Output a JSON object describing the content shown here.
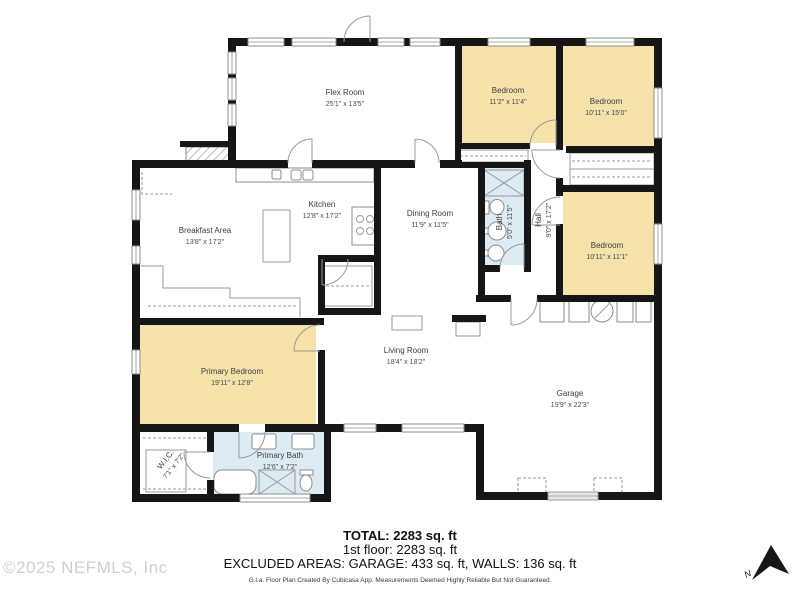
{
  "watermark": "©2025 NEFMLS, Inc",
  "compass_label": "N",
  "rooms": {
    "flex": {
      "name": "Flex Room",
      "dims": "25'1\" x 13'5\""
    },
    "bedroom1": {
      "name": "Bedroom",
      "dims": "11'2\" x 11'4\""
    },
    "bedroom2": {
      "name": "Bedroom",
      "dims": "10'11\" x 15'0\""
    },
    "kitchen": {
      "name": "Kitchen",
      "dims": "12'8\" x 17'2\""
    },
    "dining": {
      "name": "Dining Room",
      "dims": "11'9\" x 11'5\""
    },
    "bath": {
      "name": "Bath",
      "dims": "5'0\" x 11'5\""
    },
    "hall": {
      "name": "Hall",
      "dims": "9'0\" x 17'2\""
    },
    "bedroom3": {
      "name": "Bedroom",
      "dims": "10'11\" x 11'1\""
    },
    "breakfast": {
      "name": "Breakfast Area",
      "dims": "13'8\" x 17'2\""
    },
    "primary_bedroom": {
      "name": "Primary Bedroom",
      "dims": "19'11\" x 12'8\""
    },
    "living": {
      "name": "Living Room",
      "dims": "18'4\" x 18'2\""
    },
    "garage": {
      "name": "Garage",
      "dims": "19'9\" x 22'3\""
    },
    "wic": {
      "name": "W.I.C.",
      "dims": "7'1\" x 7'2\""
    },
    "primary_bath": {
      "name": "Primary Bath",
      "dims": "12'6\" x 7'2\""
    }
  },
  "summary": {
    "total": "TOTAL: 2283 sq. ft",
    "floor": "1st floor: 2283 sq. ft",
    "excluded": "EXCLUDED AREAS: GARAGE: 433 sq. ft, WALLS: 136 sq. ft",
    "disclaimer": "G.l.a. Floor Plan Created By Cubicasa App. Measurements Deemed Highly Reliable But Not Guaranteed."
  },
  "colors": {
    "room_fill": "#F6E2AB",
    "bath_fill": "#DCEBF4",
    "wall": "#161616"
  }
}
